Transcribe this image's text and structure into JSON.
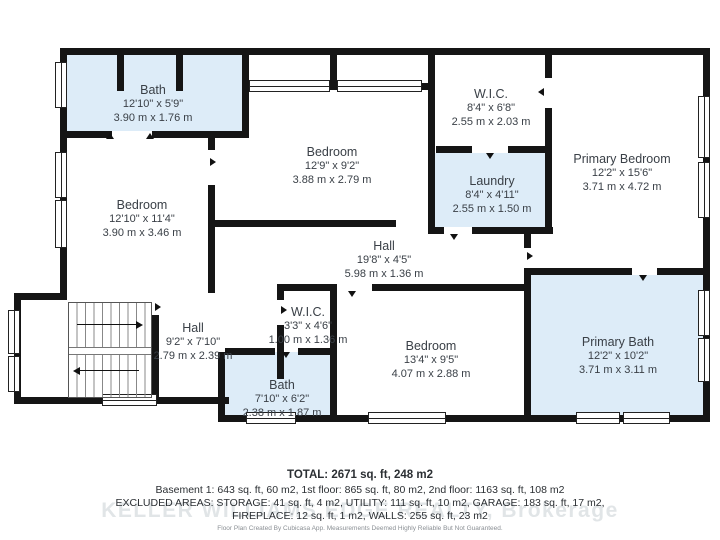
{
  "plan": {
    "rooms": [
      {
        "name": "Bath",
        "imperial": "12'10\" x 5'9\"",
        "metric": "3.90 m x 1.76 m"
      },
      {
        "name": "Bedroom",
        "imperial": "12'10\" x 11'4\"",
        "metric": "3.90 m x 3.46 m"
      },
      {
        "name": "Bedroom",
        "imperial": "12'9\" x 9'2\"",
        "metric": "3.88 m x 2.79 m"
      },
      {
        "name": "W.I.C.",
        "imperial": "8'4\" x 6'8\"",
        "metric": "2.55 m x 2.03 m"
      },
      {
        "name": "Laundry",
        "imperial": "8'4\" x 4'11\"",
        "metric": "2.55 m x 1.50 m"
      },
      {
        "name": "Primary Bedroom",
        "imperial": "12'2\" x 15'6\"",
        "metric": "3.71 m x 4.72 m"
      },
      {
        "name": "Hall",
        "imperial": "19'8\" x 4'5\"",
        "metric": "5.98 m x 1.36 m"
      },
      {
        "name": "Hall",
        "imperial": "9'2\" x 7'10\"",
        "metric": "2.79 m x 2.39 m"
      },
      {
        "name": "W.I.C.",
        "imperial": "3'3\" x 4'6\"",
        "metric": "1.00 m x 1.36 m"
      },
      {
        "name": "Bath",
        "imperial": "7'10\" x 6'2\"",
        "metric": "2.38 m x 1.87 m"
      },
      {
        "name": "Bedroom",
        "imperial": "13'4\" x 9'5\"",
        "metric": "4.07 m x 2.88 m"
      },
      {
        "name": "Primary Bath",
        "imperial": "12'2\" x 10'2\"",
        "metric": "3.71 m x 3.11 m"
      }
    ],
    "colors": {
      "wall": "#151515",
      "wet_room": "#ddecf8",
      "label_text": "#3a4047"
    }
  },
  "footer": {
    "total": "TOTAL: 2671 sq. ft, 248 m2",
    "line1": "Basement 1: 643 sq. ft, 60 m2, 1st floor: 865 sq. ft, 80 m2, 2nd floor: 1163 sq. ft, 108 m2",
    "line2": "EXCLUDED AREAS: STORAGE: 41 sq. ft, 4 m2, UTILITY: 111 sq. ft, 10 m2, GARAGE: 183 sq. ft, 17 m2,",
    "line3": "FIREPLACE: 12 sq. ft, 1 m2, WALLS: 255 sq. ft, 23 m2",
    "watermark": "KELLER WILLIAMS EDGE REALTY, Brokerage",
    "disclaimer": "Floor Plan Created By Cubicasa App. Measurements Deemed Highly Reliable But Not Guaranteed."
  }
}
